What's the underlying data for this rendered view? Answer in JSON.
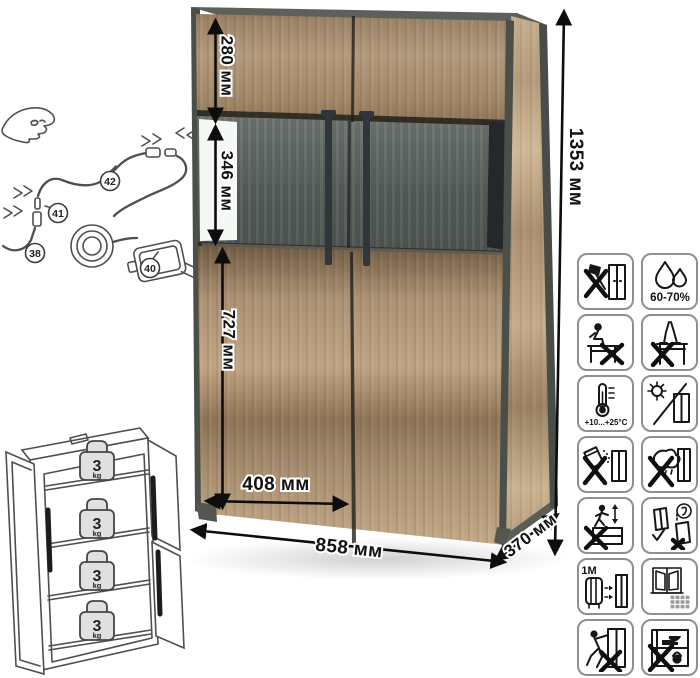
{
  "dimensions": {
    "upper_section_height": "280 мм",
    "glass_section_height": "346 мм",
    "lower_section_height": "727 мм",
    "inner_width": "408 мм",
    "overall_width": "858 мм",
    "depth": "370 мм",
    "overall_height": "1353 мм"
  },
  "wiring": {
    "labels": {
      "led_strip": "38",
      "strip_connector": "41",
      "cable_coupler": "42",
      "power_adapter": "40"
    }
  },
  "shelf_load": {
    "shelves": [
      {
        "value": "3",
        "unit": "kg"
      },
      {
        "value": "3",
        "unit": "kg"
      },
      {
        "value": "3",
        "unit": "kg"
      },
      {
        "value": "3",
        "unit": "kg"
      }
    ]
  },
  "care_icons": {
    "humidity_range": "60-70%",
    "temperature_range": "+10...+25°C",
    "heater_distance": "≥1M",
    "items": [
      "no-sharp-tools",
      "humidity-60-70-percent",
      "no-sitting-on-furniture",
      "no-standing-on-furniture",
      "temperature-plus10-plus25",
      "no-direct-sunlight",
      "no-abrasive-cleaners",
      "no-wet-cleaning",
      "no-jumping-on-furniture",
      "transport-upright",
      "keep-1m-from-heaters",
      "ventilate-room",
      "no-tilting-pulling",
      "no-heavy-items-inside"
    ]
  },
  "colors": {
    "wood": "#b1977a",
    "wood_dark": "#8a7057",
    "frame_dark": "#50544e",
    "glass_interior": "#4a504d",
    "handle": "#30363a",
    "dimension_line": "#0d0d0d"
  }
}
